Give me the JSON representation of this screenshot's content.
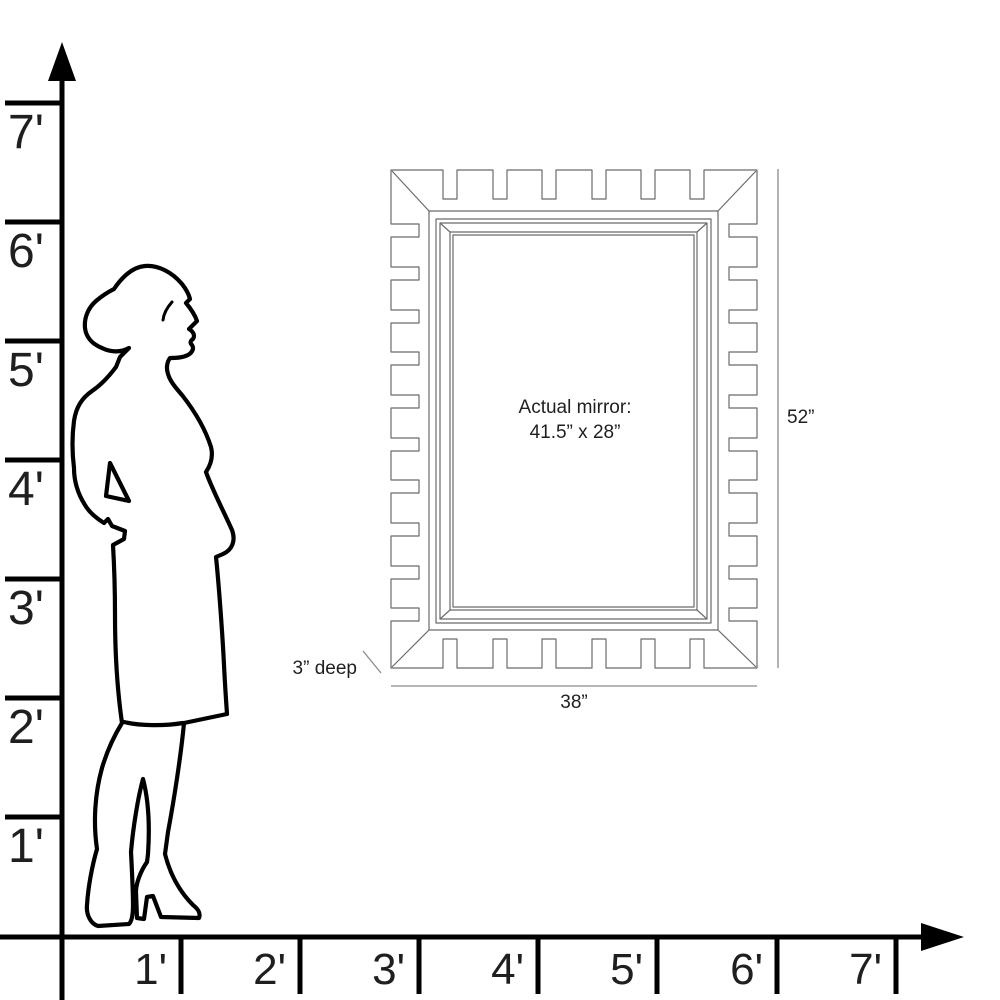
{
  "y_axis": {
    "ticks": [
      {
        "label": "7'",
        "y": 103
      },
      {
        "label": "6'",
        "y": 222
      },
      {
        "label": "5'",
        "y": 341
      },
      {
        "label": "4'",
        "y": 460
      },
      {
        "label": "3'",
        "y": 579
      },
      {
        "label": "2'",
        "y": 698
      },
      {
        "label": "1'",
        "y": 817
      }
    ]
  },
  "x_axis": {
    "ticks": [
      {
        "label": "1'",
        "x": 181
      },
      {
        "label": "2'",
        "x": 300
      },
      {
        "label": "3'",
        "x": 419
      },
      {
        "label": "4'",
        "x": 538
      },
      {
        "label": "5'",
        "x": 657
      },
      {
        "label": "6'",
        "x": 777
      },
      {
        "label": "7'",
        "x": 896
      }
    ]
  },
  "mirror_annotations": {
    "center_line1": "Actual mirror:",
    "center_line2": "41.5” x 28”",
    "height": "52”",
    "width": "38”",
    "depth": "3” deep"
  },
  "colors": {
    "ink": "#000000",
    "frame_line": "#6b6b6b",
    "dim_line": "#8a8a8a",
    "text": "#1f1f1f"
  }
}
